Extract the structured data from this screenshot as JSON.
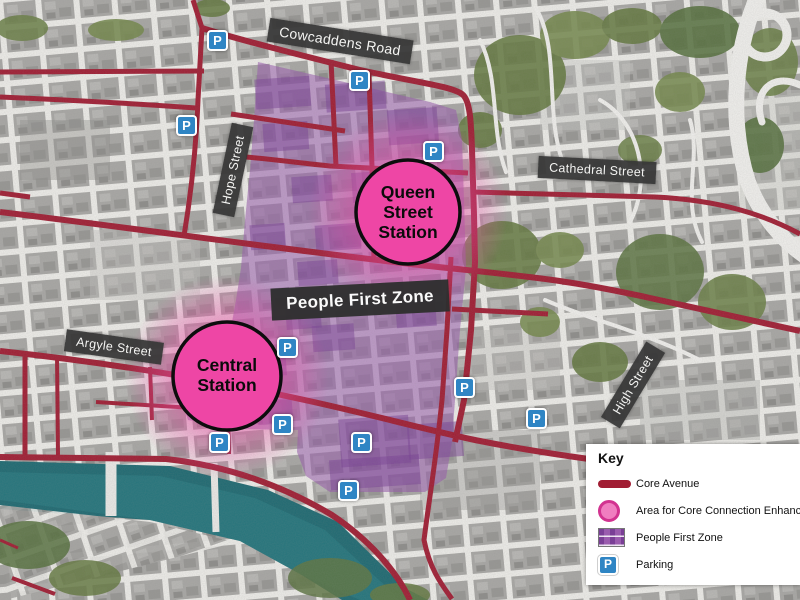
{
  "map": {
    "street_labels": [
      {
        "id": "cowcaddens",
        "text": "Cowcaddens Road"
      },
      {
        "id": "cathedral",
        "text": "Cathedral Street"
      },
      {
        "id": "hope",
        "text": "Hope Street"
      },
      {
        "id": "argyle",
        "text": "Argyle Street"
      },
      {
        "id": "high",
        "text": "High Street"
      }
    ],
    "zone_label": "People First Zone",
    "stations": [
      {
        "id": "queen",
        "lines": [
          "Queen",
          "Street",
          "Station"
        ]
      },
      {
        "id": "central",
        "lines": [
          "Central",
          "Station"
        ]
      }
    ],
    "parking_glyph": "P"
  },
  "legend": {
    "title": "Key",
    "items": [
      {
        "label": "Core Avenue"
      },
      {
        "label": "Area for Core Connection Enhancement"
      },
      {
        "label": "People First Zone"
      },
      {
        "label": "Parking"
      }
    ]
  },
  "colors": {
    "core_avenue_red": "#a11d33",
    "enhancement_pink": "#f145a6",
    "station_circle_pink": "#ee46a5",
    "people_first_zone_purple": "#9a5cae",
    "parking_blue": "#2f85c4",
    "river_teal": "#1e6a72",
    "label_dark": "#383838"
  }
}
